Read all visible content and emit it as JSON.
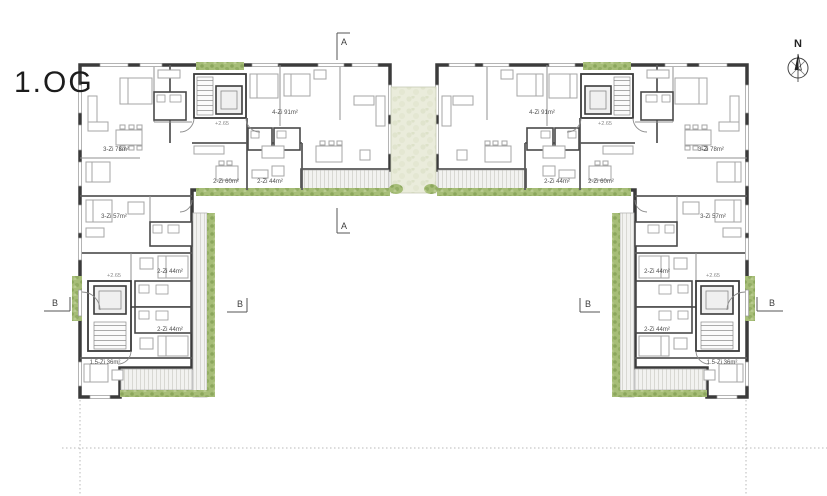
{
  "title": "1.OG",
  "compass": {
    "north_label": "N"
  },
  "section_markers": {
    "a": "A",
    "b": "B"
  },
  "colors": {
    "wall": "#3b3b3b",
    "planting": "#a6bd77",
    "courtyard_garden": "#eaecdb",
    "deck": "#f2f2f0"
  },
  "buildings": [
    {
      "id": "west-block",
      "units": [
        {
          "label": "3-Zi 78m²"
        },
        {
          "label": "4-Zi 91m²"
        },
        {
          "label": "2-Zi 60m²"
        },
        {
          "label": "2-Zi 44m²"
        },
        {
          "label": "3-Zi 57m²"
        },
        {
          "label": "2-Zi 44m²"
        },
        {
          "label": "2-Zi 44m²"
        },
        {
          "label": "1.5-Zi 36m²"
        }
      ],
      "elevations": [
        "+2.65",
        "+2.65"
      ]
    },
    {
      "id": "east-block",
      "units": [
        {
          "label": "3-Zi 78m²"
        },
        {
          "label": "4-Zi 91m²"
        },
        {
          "label": "2-Zi 60m²"
        },
        {
          "label": "2-Zi 44m²"
        },
        {
          "label": "3-Zi 57m²"
        },
        {
          "label": "2-Zi 44m²"
        },
        {
          "label": "2-Zi 44m²"
        },
        {
          "label": "1.5-Zi 36m²"
        }
      ],
      "elevations": [
        "+2.65",
        "+2.65"
      ]
    }
  ]
}
